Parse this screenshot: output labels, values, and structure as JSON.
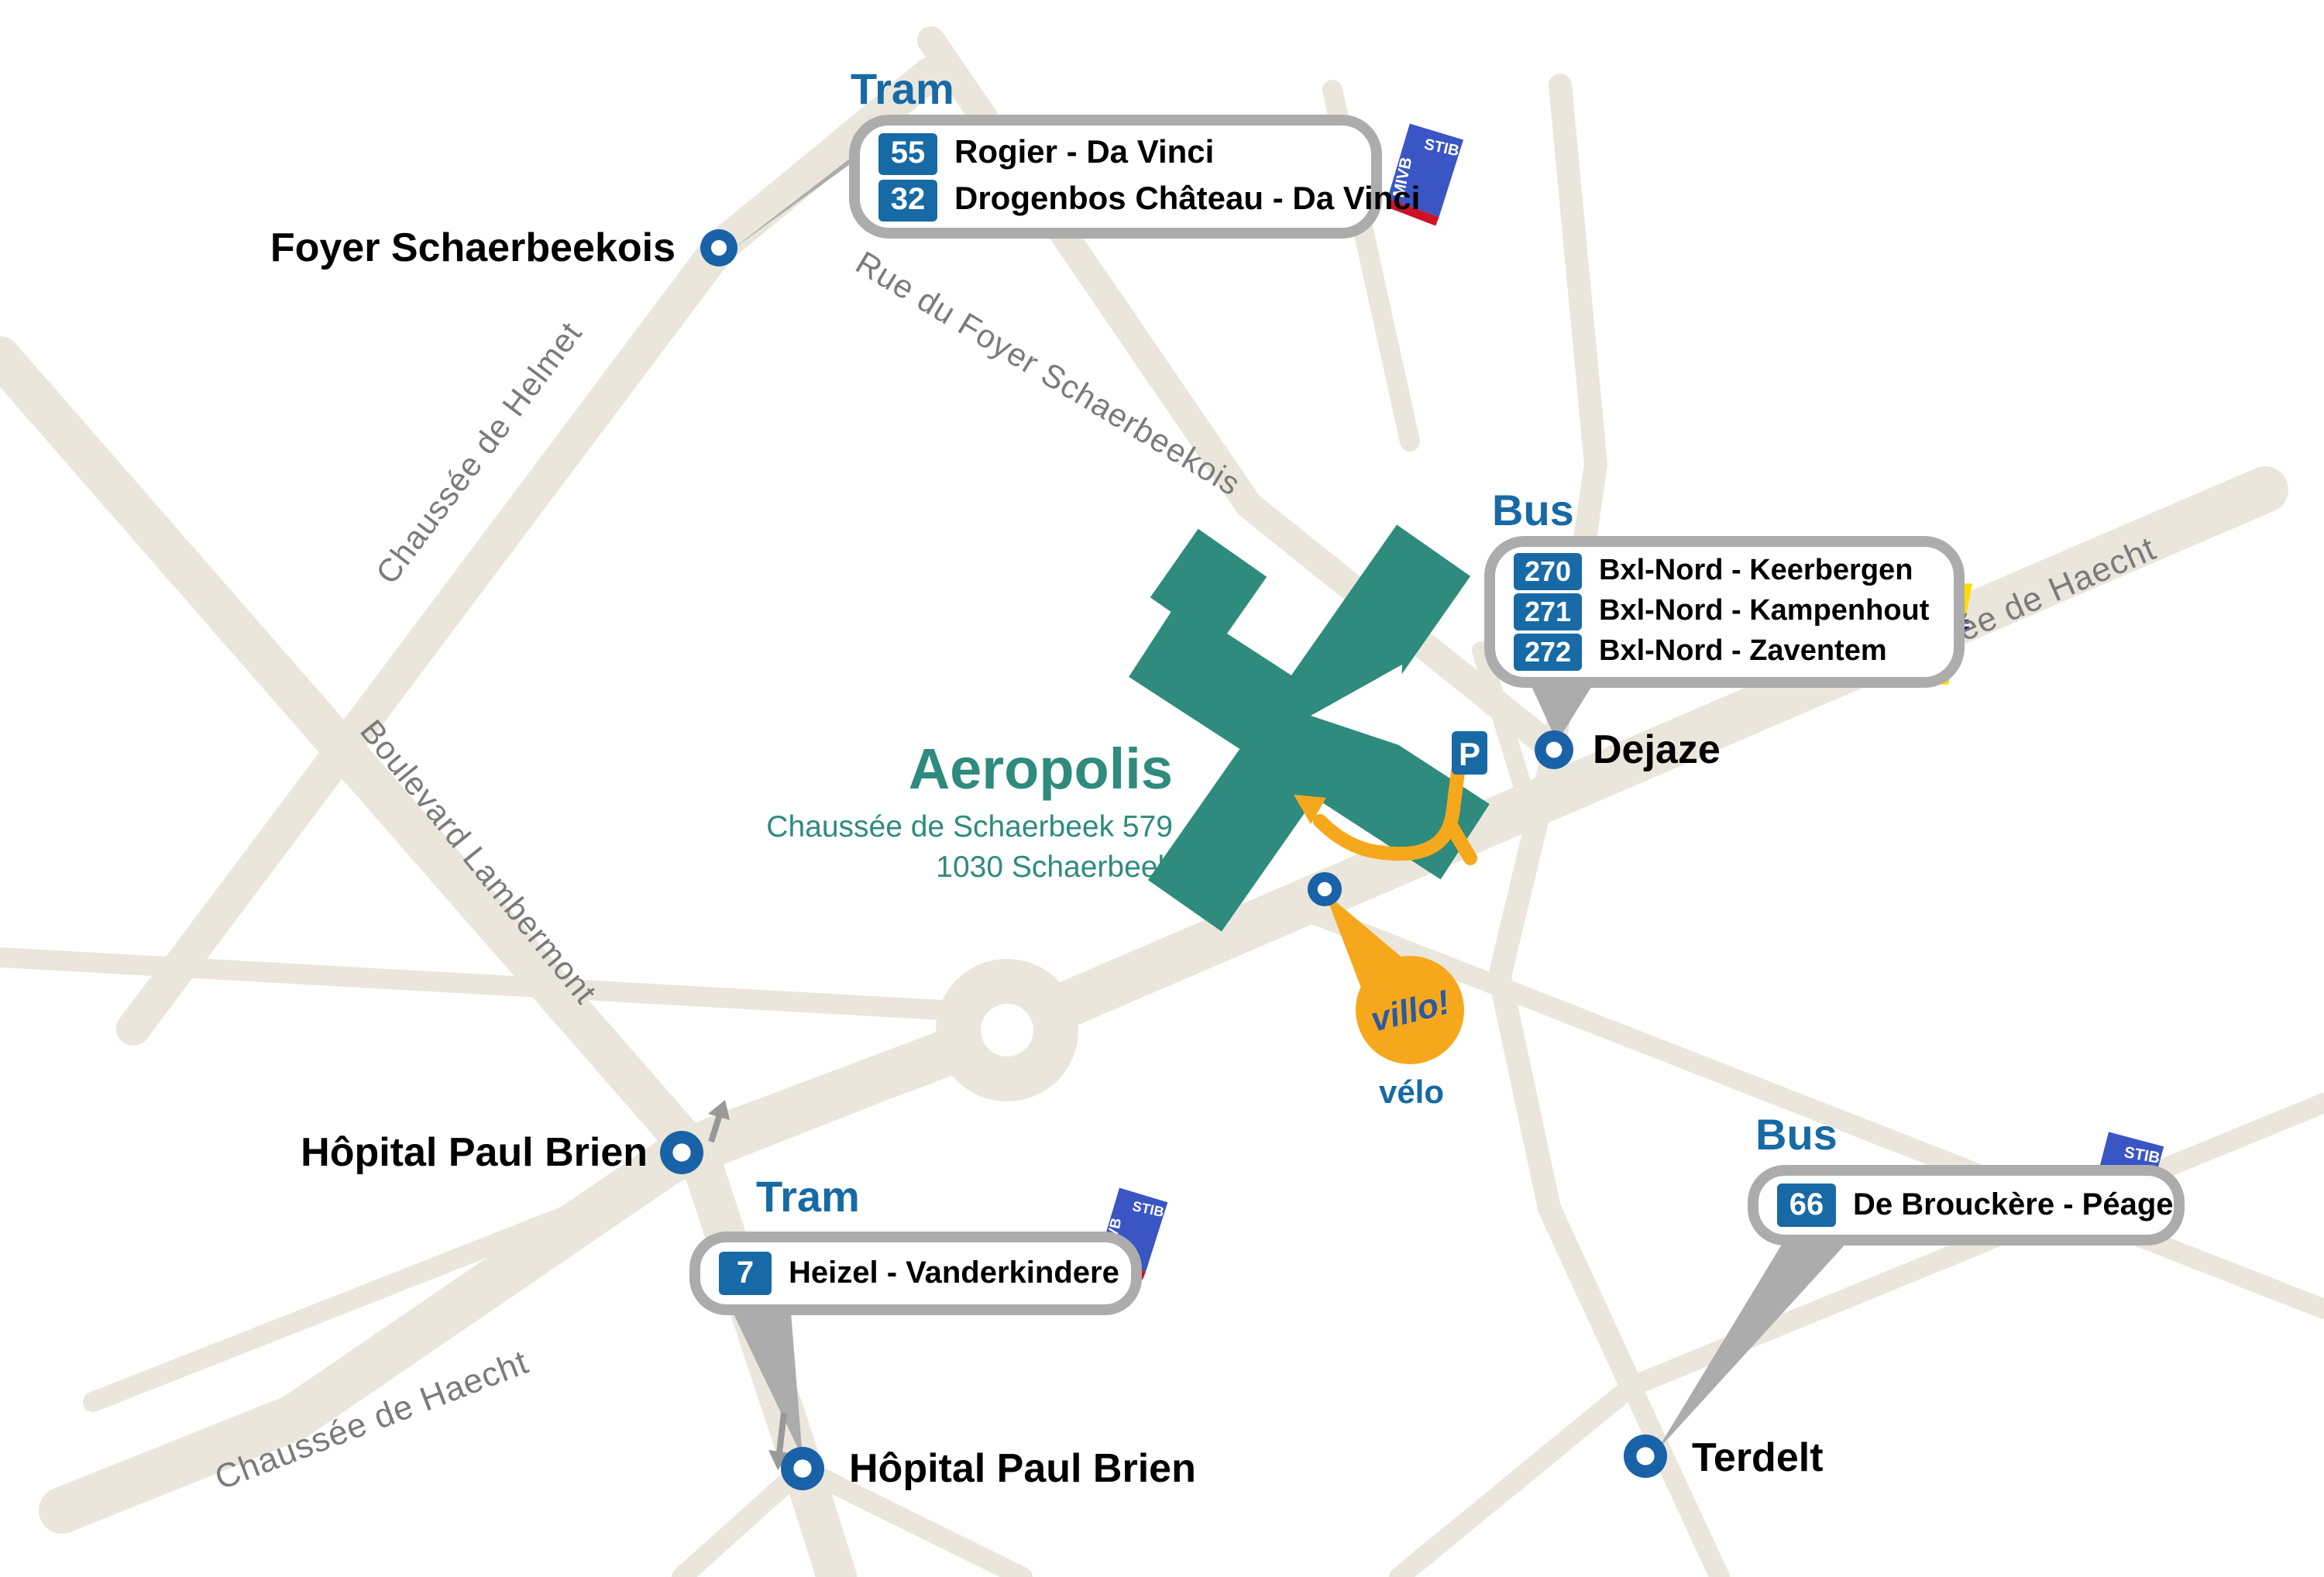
{
  "building": {
    "name": "Aeropolis",
    "address_line1": "Chaussée de Schaerbeek 579",
    "address_line2": "1030 Schaerbeek"
  },
  "streets": {
    "helmet": "Chaussée de Helmet",
    "foyer": "Rue du Foyer Schaerbeekois",
    "lambermont": "Boulevard Lambermont",
    "haecht_ne": "Chaussée de Haecht",
    "haecht_sw": "Chaussée de Haecht"
  },
  "stops": {
    "foyer": "Foyer Schaerbeekois",
    "dejaze": "Dejaze",
    "hopital_north": "Hôpital Paul Brien",
    "hopital_south": "Hôpital Paul Brien",
    "terdelt": "Terdelt"
  },
  "callouts": {
    "tram_north": {
      "title": "Tram",
      "lines": [
        {
          "num": "55",
          "route": "Rogier - Da Vinci"
        },
        {
          "num": "32",
          "route": "Drogenbos Château - Da Vinci"
        }
      ]
    },
    "bus_north": {
      "title": "Bus",
      "lines": [
        {
          "num": "270",
          "route": "Bxl-Nord - Keerbergen"
        },
        {
          "num": "271",
          "route": "Bxl-Nord - Kampenhout"
        },
        {
          "num": "272",
          "route": "Bxl-Nord - Zaventem"
        }
      ]
    },
    "tram_south": {
      "title": "Tram",
      "lines": [
        {
          "num": "7",
          "route": "Heizel - Vanderkindere"
        }
      ]
    },
    "bus_southeast": {
      "title": "Bus",
      "lines": [
        {
          "num": "66",
          "route": "De Brouckère - Péage"
        }
      ]
    }
  },
  "operators": {
    "stib": {
      "nl": "MIVB",
      "fr": "STIB"
    },
    "delijn": {
      "prefix": "DE",
      "name": "LIJN"
    }
  },
  "bike": {
    "brand": "villo!",
    "label": "vélo"
  },
  "parking": {
    "label": "P"
  },
  "colors": {
    "blue": "#176AA5",
    "marker_blue": "#1A62A8",
    "teal": "#2E8B7D",
    "orange": "#F6A81C",
    "road": "#EAE6DB",
    "callout_border": "#ACACAC",
    "street_text": "#7B7B7B",
    "stib_blue": "#3A55C4",
    "stib_red": "#CE1126",
    "delijn_yellow": "#FBDB00",
    "delijn_navy": "#1A2E75"
  }
}
